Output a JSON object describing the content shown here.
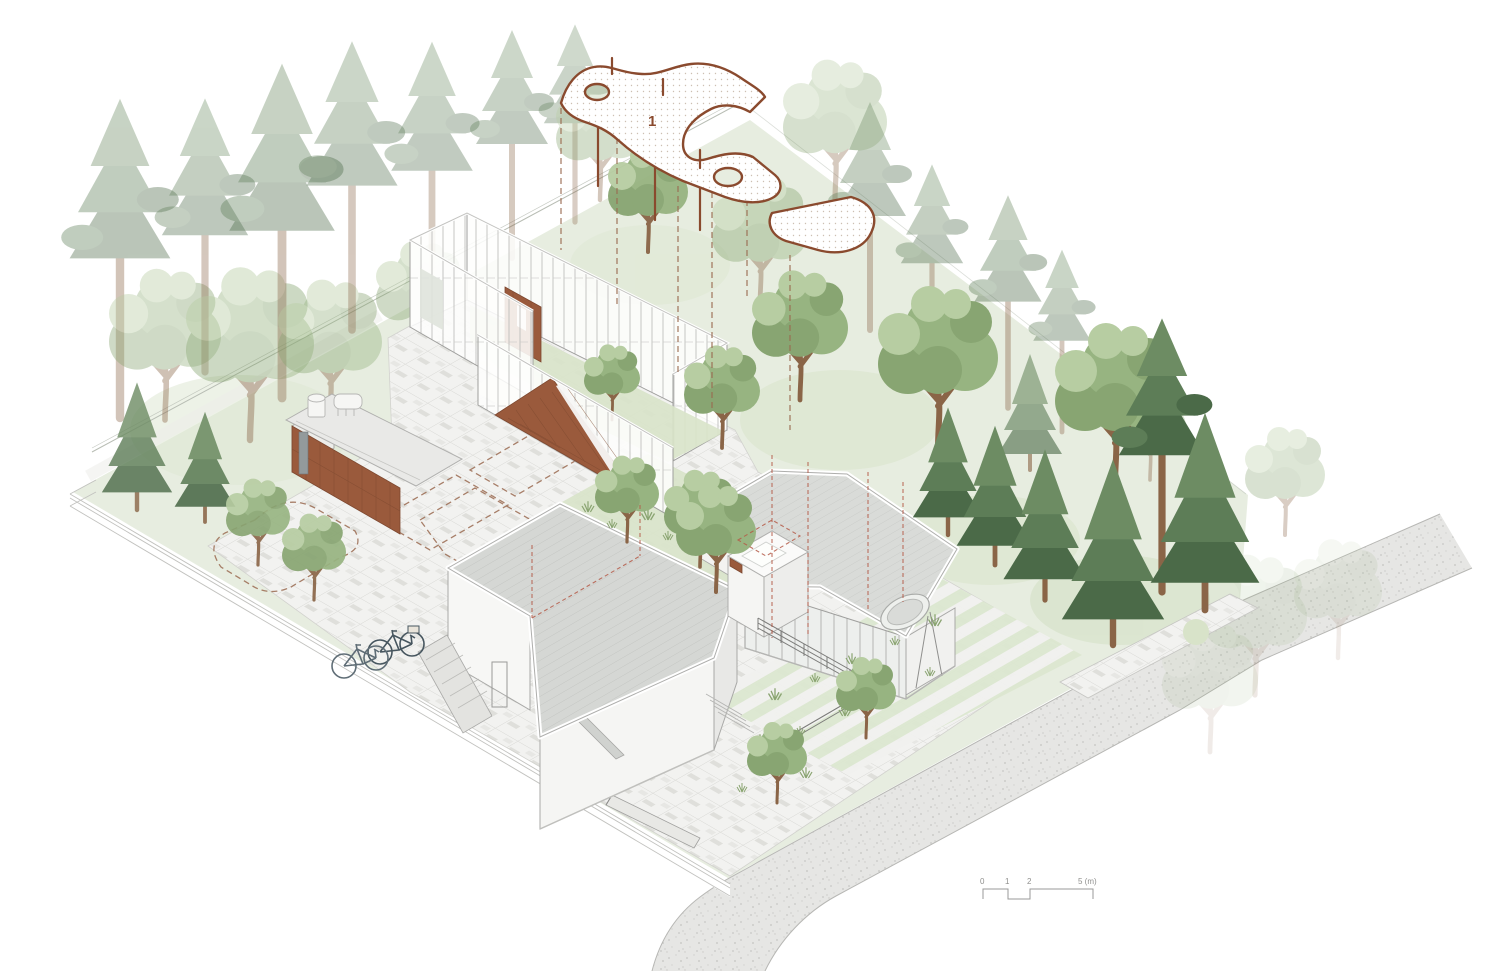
{
  "document": {
    "kind": "architectural-axonometric-site-plan",
    "background": "#ffffff"
  },
  "annotations": {
    "roof_plan_number": "1"
  },
  "scale_bar": {
    "tick_labels": [
      "0",
      "1",
      "2",
      "5 (m)"
    ]
  },
  "colors": {
    "corten": "#9a5a3c",
    "corten-dark": "#7d4830",
    "plan-outline": "#8a4a2e",
    "projection-dash": "#9a6a50",
    "red-dash": "#b45a48",
    "paving": "#f2f2f0",
    "paving-tile": "#dcdcd7",
    "wall": "#fbfbfa",
    "mullion": "#b5b5b3",
    "roof": "#d5d7d4",
    "roof-east": "#d9dbd8",
    "lawn": "#e7ede0",
    "lawn-bright": "#d8e3c9",
    "conifer": "#5d7d57",
    "conifer-dark": "#4b6a48",
    "deciduous": "#97b481",
    "deciduous-light": "#b7cda2",
    "trunk": "#8a6547",
    "road": "#e6e6e4",
    "edge": "#b7b7b4",
    "scale": "#8f8f8d"
  }
}
